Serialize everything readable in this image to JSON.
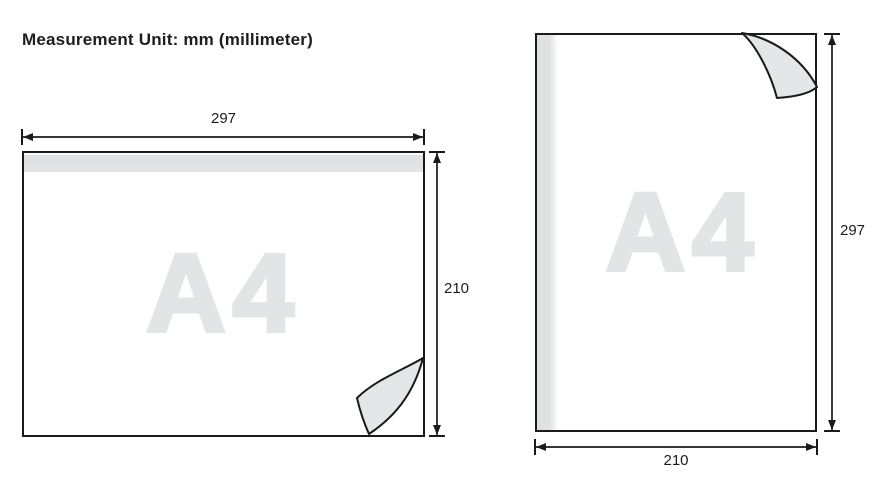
{
  "title": "Measurement Unit: mm (millimeter)",
  "unit": "mm",
  "colors": {
    "background": "#ffffff",
    "line": "#1a1a1a",
    "text": "#1d1d1f",
    "binding_strip": "#dfe2e4",
    "watermark": "#e2e4e6",
    "curl_fill": "#e4e6e8"
  },
  "sheets": {
    "landscape": {
      "name": "A4",
      "width_mm": "297",
      "height_mm": "210"
    },
    "portrait": {
      "name": "A4",
      "width_mm": "210",
      "height_mm": "297"
    }
  }
}
